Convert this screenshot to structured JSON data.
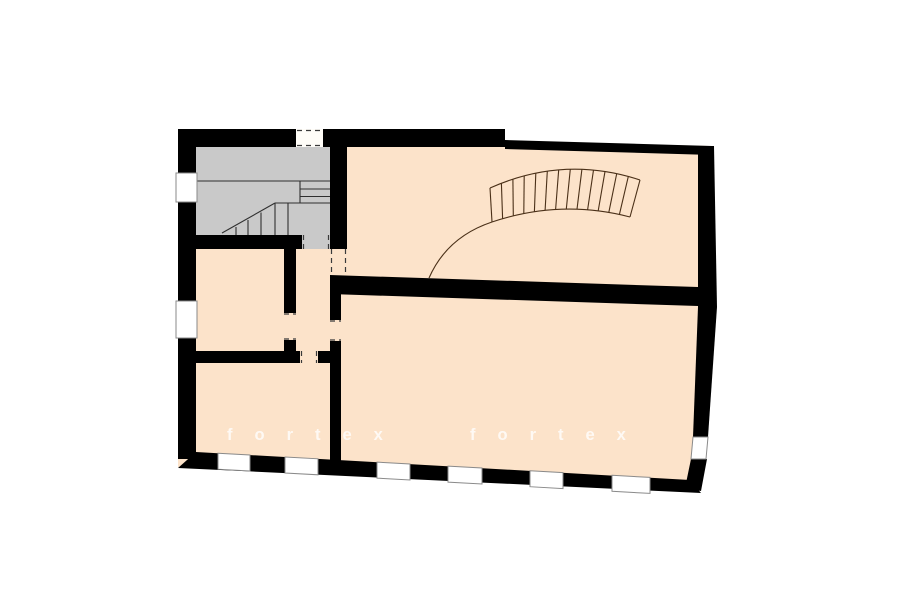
{
  "watermark": {
    "first": "fortex",
    "second": "fortex"
  },
  "colors": {
    "background": "#ffffff",
    "wall": "#000000",
    "room_fill": "#fce3ca",
    "stairwell_fill": "#c9c9c9",
    "stair_line": "#2f2f2f",
    "curved_stair_line": "#4a3018",
    "window_fill": "#ffffff",
    "watermark": "#ffffff"
  }
}
